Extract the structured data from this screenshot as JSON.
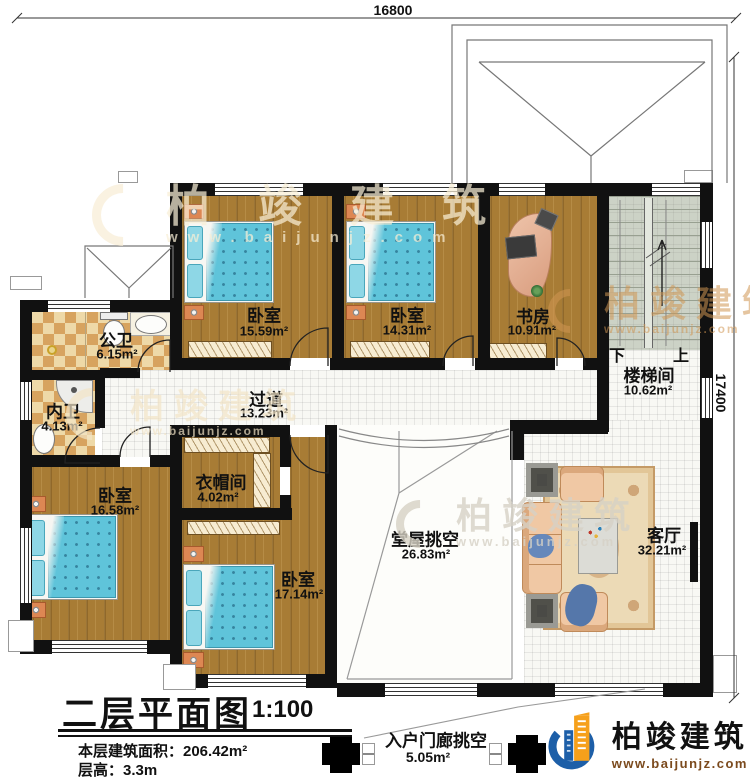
{
  "dimensions": {
    "top": "16800",
    "right": "17400"
  },
  "rooms": {
    "bedroom1": {
      "name": "卧室",
      "area": "15.59m²"
    },
    "bedroom2": {
      "name": "卧室",
      "area": "14.31m²"
    },
    "study": {
      "name": "书房",
      "area": "10.91m²"
    },
    "stairwell": {
      "name": "楼梯间",
      "area": "10.62m²",
      "down": "下",
      "up": "上"
    },
    "public_bath": {
      "name": "公卫",
      "area": "6.15m²"
    },
    "private_bath": {
      "name": "内卫",
      "area": "4.13m²"
    },
    "corridor": {
      "name": "过道",
      "area": "13.23m²"
    },
    "cloakroom": {
      "name": "衣帽间",
      "area": "4.02m²"
    },
    "bedroom3": {
      "name": "卧室",
      "area": "16.58m²"
    },
    "bedroom4": {
      "name": "卧室",
      "area": "17.14m²"
    },
    "hall_void": {
      "name": "堂屋挑空",
      "area": "26.83m²"
    },
    "living": {
      "name": "客厅",
      "area": "32.21m²"
    },
    "porch_void": {
      "name": "入户门廊挑空",
      "area": "5.05m²"
    }
  },
  "title_block": {
    "title": "二层平面图",
    "scale": "1:100",
    "area_line": "本层建筑面积：206.42m²",
    "height_line": "层高：3.3m"
  },
  "brand": {
    "name": "柏竣建筑",
    "website": "www.baijunjz.com"
  },
  "watermark": {
    "name": "柏竣建筑",
    "website": "www.baijunjz.com"
  },
  "colors": {
    "wall": "#111111",
    "wood": "#a87c35",
    "bed_blue": "#5fc4da",
    "checker": "#d7a35f",
    "stair": "#ccd2c6",
    "brand_blue": "#1d5fa8",
    "brand_orange": "#f6a01b"
  }
}
